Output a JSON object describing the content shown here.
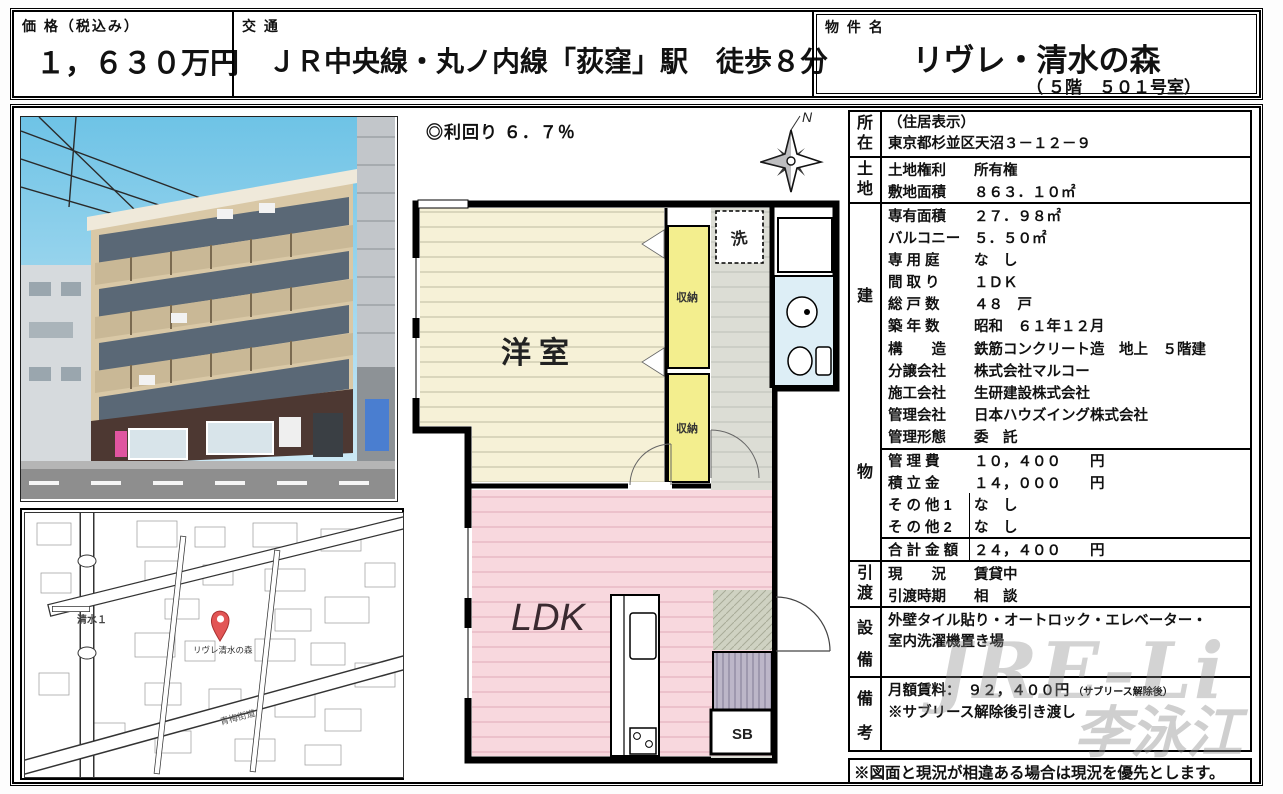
{
  "header": {
    "price_label": "価 格（税込み）",
    "price_value": "１，６３０万円",
    "transport_label": "交 通",
    "transport_value": "ＪＲ中央線・丸ノ内線「荻窪」駅　徒歩８分",
    "name_label": "物 件 名",
    "name_value": "リヴレ・清水の森",
    "name_sub": "（ ５階　５０１号室）"
  },
  "middle": {
    "yield_text": "◎利回り ６．７％",
    "compass_n": "N",
    "plan_labels": {
      "western_room": "洋室",
      "storage_upper": "収納",
      "storage_lower": "収納",
      "washer": "洗",
      "ldk": "LDK",
      "shoe_box": "SB"
    }
  },
  "map": {
    "district_label": "清水１",
    "road_label": "青梅街道",
    "pin_label": "リヴレ清水の森"
  },
  "details": {
    "location": {
      "label_top": "所",
      "label_bottom": "在",
      "line1": "（住居表示）",
      "line2": "東京都杉並区天沼３－１２－９"
    },
    "land": {
      "label_top": "土",
      "label_bottom": "地",
      "rows": [
        {
          "k": "土地権利",
          "v": "所有権"
        },
        {
          "k": "敷地面積",
          "v": "８６３．１０㎡"
        }
      ]
    },
    "building": {
      "label_top": "建",
      "label_bottom": "物",
      "rows_a": [
        {
          "k": "専有面積",
          "v": "２７．９８㎡"
        },
        {
          "k": "バルコニー",
          "v": "５．５０㎡"
        },
        {
          "k": "専 用 庭",
          "v": "な　し"
        },
        {
          "k": "間 取 り",
          "v": "１ＤＫ"
        },
        {
          "k": "総 戸 数",
          "v": "４８　戸"
        },
        {
          "k": "築 年 数",
          "v": "昭和　６１年１２月"
        },
        {
          "k": "構　　造",
          "v": "鉄筋コンクリート造　地上　５階建"
        },
        {
          "k": "分譲会社",
          "v": "株式会社マルコー"
        },
        {
          "k": "施工会社",
          "v": "生研建設株式会社"
        },
        {
          "k": "管理会社",
          "v": "日本ハウズイング株式会社"
        },
        {
          "k": "管理形態",
          "v": "委　託"
        }
      ],
      "rows_b": [
        {
          "k": "管 理 費",
          "v": "１０，４００　　円"
        },
        {
          "k": "積 立 金",
          "v": "１４，０００　　円"
        },
        {
          "k": "そ の 他 1",
          "v": "な　し"
        },
        {
          "k": "そ の 他 2",
          "v": "な　し"
        }
      ],
      "total": {
        "k": "合 計 金 額",
        "v": "２４，４００　　円"
      }
    },
    "handover": {
      "label_top": "引",
      "label_bottom": "渡",
      "rows": [
        {
          "k": "現　　況",
          "v": "賃貸中"
        },
        {
          "k": "引渡時期",
          "v": "相　談"
        }
      ]
    },
    "facilities": {
      "label_top": "設",
      "label_bottom": "備",
      "line1": "外壁タイル貼り・オートロック・エレベーター・",
      "line2": "室内洗濯機置き場"
    },
    "remarks": {
      "label_top": "備",
      "label_bottom": "考",
      "line1": "月額賃料：　９２，４００円",
      "line1_note": "（サブリース解除後）",
      "line2": "※サブリース解除後引き渡し"
    }
  },
  "footer": {
    "note": "※図面と現況が相違ある場合は現況を優先とします。"
  },
  "watermark": {
    "line1": "JRE-Li",
    "line2": "李泳江"
  },
  "colors": {
    "western_room": "#f6f1d7",
    "storage": "#f3ee8e",
    "ldk": "#f8d8de",
    "corridor": "#dcddd5",
    "bath": "#ddeef6",
    "genkan": "#bcb6c8",
    "pin": "#e25555"
  }
}
